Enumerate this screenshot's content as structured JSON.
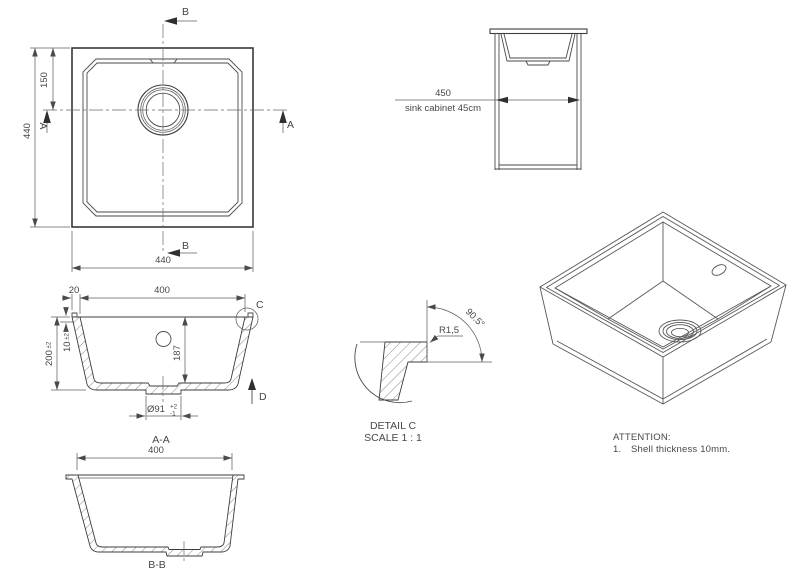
{
  "top_view": {
    "dim_height_left": "440",
    "dim_drain_offset": "150",
    "dim_width_bottom": "440",
    "section_a_left": "A",
    "section_a_right": "A",
    "section_b_top": "B",
    "section_b_bottom": "B"
  },
  "cabinet_view": {
    "dim_width": "450",
    "caption": "sink cabinet 45cm"
  },
  "section_aa": {
    "title": "A-A",
    "dim_rim": "20",
    "dim_inner_width": "400",
    "dim_height": "200",
    "dim_height_tol": "±2",
    "dim_shell": "10",
    "dim_shell_tol": "±2",
    "dim_depth": "187",
    "dim_drain": "Ø91",
    "dim_drain_tol_plus": "+2",
    "dim_drain_tol_minus": "-1",
    "detail_label": "C",
    "direction_label": "D"
  },
  "section_bb": {
    "title": "B-B",
    "dim_inner_width": "400"
  },
  "detail_c": {
    "title": "DETAIL C",
    "scale": "SCALE 1 : 1",
    "radius": "R1,5",
    "angle": "90.5°"
  },
  "attention": {
    "title": "ATTENTION:",
    "item_number": "1.",
    "item_text": "Shell thickness 10mm."
  },
  "colors": {
    "background": "#ffffff",
    "line": "#3d3d3d",
    "dimension": "#5f5f5f",
    "text": "#474747"
  }
}
